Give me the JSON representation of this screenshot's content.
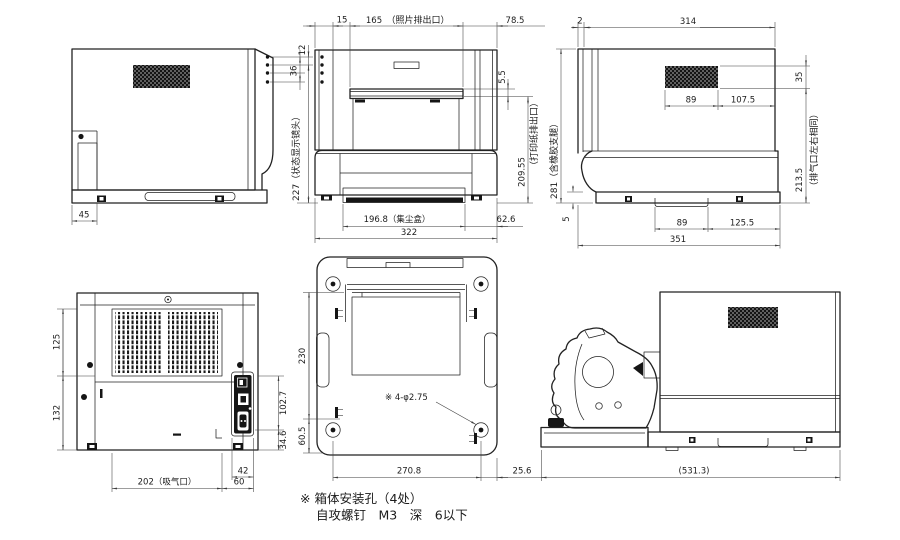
{
  "title": "printer-outline-dimension-drawing",
  "note": {
    "line1": "※ 箱体安装孔（4处）",
    "line2": "自攻螺钉　M3　深　6以下"
  },
  "colors": {
    "line": "#222222",
    "dim": "#3c3c3c",
    "background": "#ffffff"
  },
  "views": {
    "left_side": {
      "dims": {
        "d45": "45"
      }
    },
    "front": {
      "dims": {
        "d15": "15",
        "d165": "165",
        "photo_exit": "（照片排出口）",
        "d78_5": "78.5",
        "d12": "12",
        "d36": "36",
        "status_lens": "227（状态显示镜头）",
        "d5_5": "5.5",
        "d209_55": "209.55",
        "paper_exit": "（打印纸排出口）",
        "dust_box": "196.8（集尘盒）",
        "d62_6": "62.6",
        "d322": "322"
      }
    },
    "right_side": {
      "dims": {
        "d2": "2",
        "d314": "314",
        "rubber_feet": "281（含橡胶支腿）",
        "d35": "35",
        "d89_vent": "89",
        "d107_5": "107.5",
        "d213_5": "213.5",
        "exhaust_note": "（排气口左右相同）",
        "d5": "5",
        "d89_handle": "89",
        "d125_5": "125.5",
        "d351": "351"
      }
    },
    "rear": {
      "dims": {
        "d125": "125",
        "d132": "132",
        "d102_7": "102.7",
        "d34_6": "34.6",
        "intake": "202（吸气口）",
        "d42": "42",
        "d60": "60"
      }
    },
    "bottom": {
      "dims": {
        "d230": "230",
        "d60_5": "60.5",
        "d270_8": "270.8",
        "d25_6": "25.6",
        "mount_holes": "※ 4-φ2.75"
      }
    },
    "side_open": {
      "dims": {
        "d531_3": "(531.3)"
      }
    }
  }
}
